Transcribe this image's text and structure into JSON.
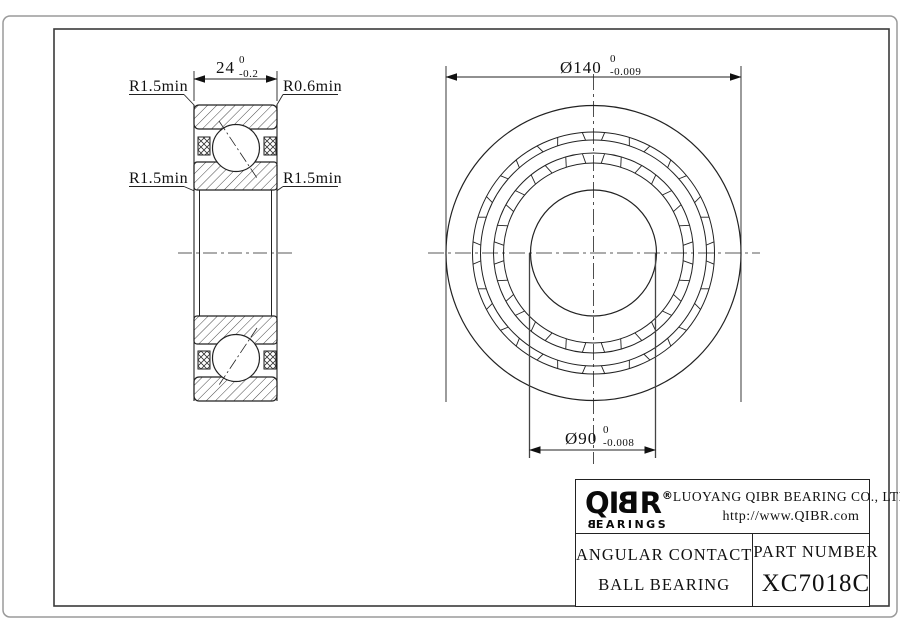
{
  "drawing": {
    "section_view": {
      "width_dim": {
        "value": "24",
        "tol_upper": "0",
        "tol_lower": "-0.2"
      },
      "fillet_top_left": "R1.5min",
      "fillet_top_right": "R0.6min",
      "fillet_mid_left": "R1.5min",
      "fillet_mid_right": "R1.5min"
    },
    "front_view": {
      "outer_dia_dim": {
        "value": "Ø140",
        "tol_upper": "0",
        "tol_lower": "-0.009"
      },
      "bore_dia_dim": {
        "value": "Ø90",
        "tol_upper": "0",
        "tol_lower": "-0.008"
      }
    }
  },
  "title_block": {
    "logo": {
      "prefix": "QI",
      "mirrored_letter": "B",
      "suffix": "R",
      "registered_mark": "®",
      "tagline_first_letter": "B",
      "tagline_rest": "EARINGS"
    },
    "company_name": "LUOYANG QIBR BEARING CO., LTD",
    "website": "http://www.QIBR.com",
    "product_type_line1": "ANGULAR CONTACT",
    "product_type_line2": "BALL BEARING",
    "part_number_label": "PART NUMBER",
    "part_number": "XC7018C"
  }
}
